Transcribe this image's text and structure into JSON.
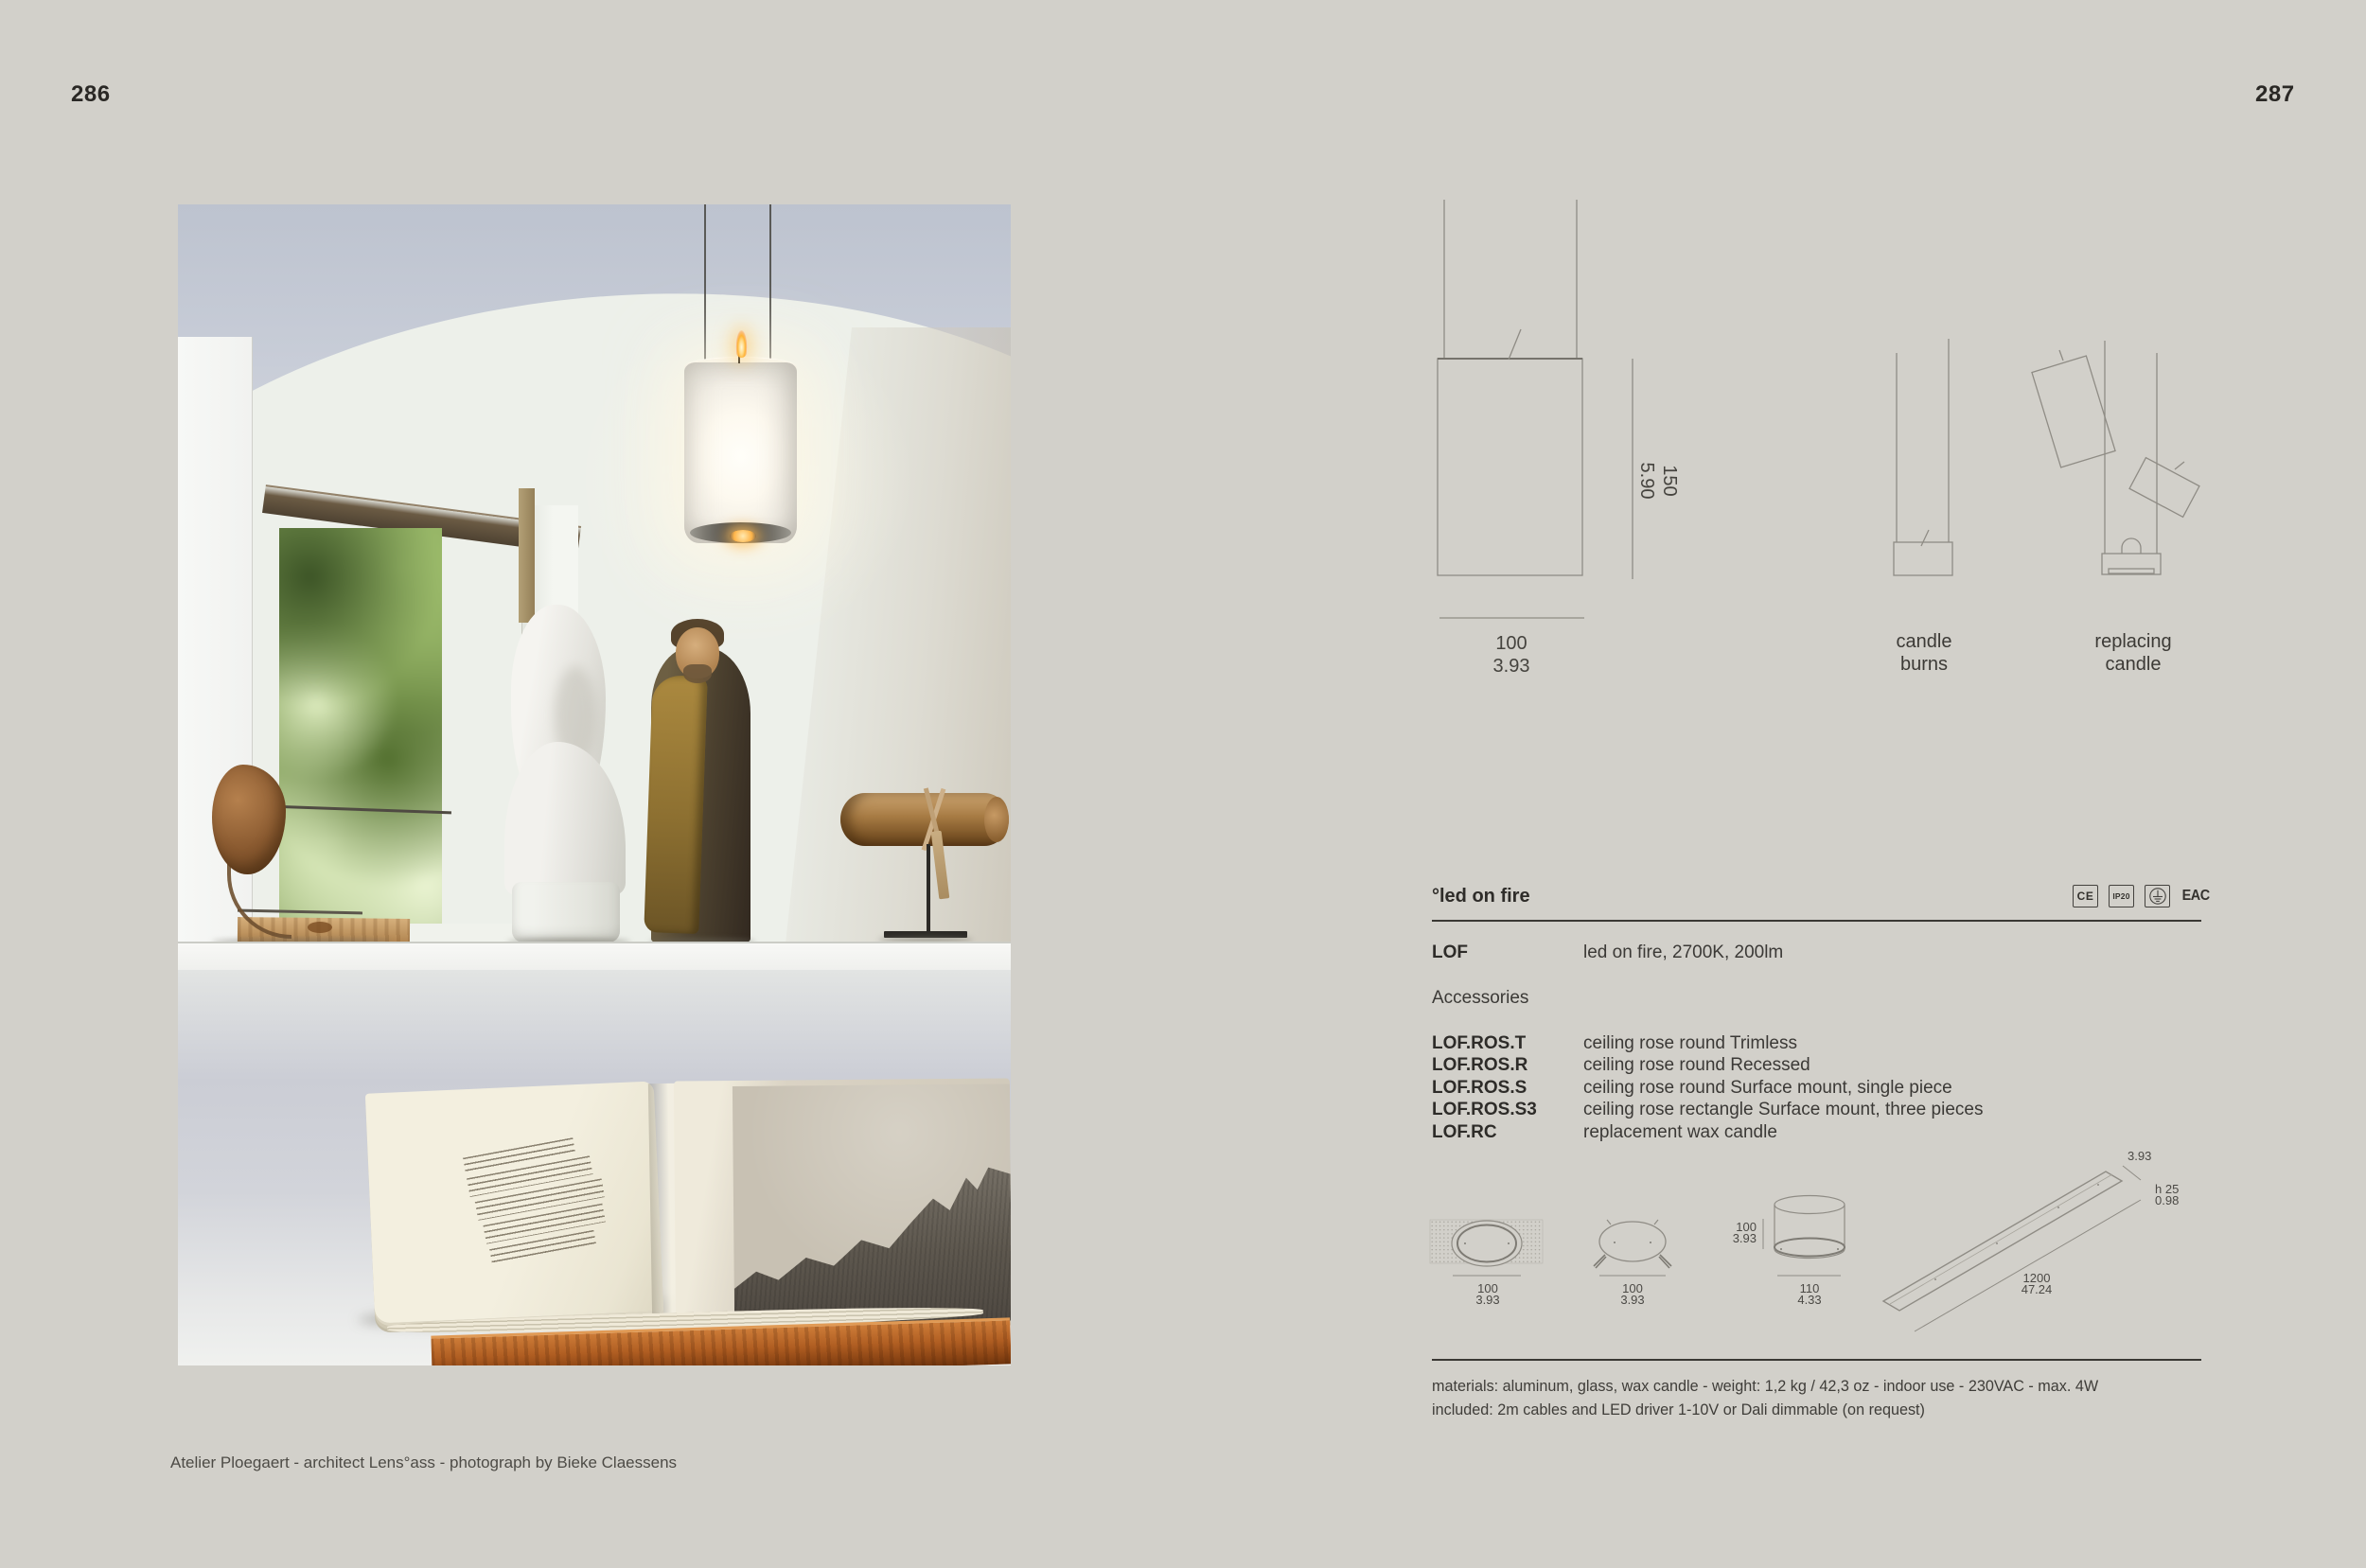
{
  "page": {
    "left_number": "286",
    "right_number": "287",
    "caption": "Atelier Ploegaert - architect Lens°ass - photograph by Bieke Claessens"
  },
  "pendant_diagram": {
    "height_mm": "150",
    "height_in": "5.90",
    "width_mm": "100",
    "width_in": "3.93"
  },
  "sequence_diagrams": {
    "burn_line1": "candle",
    "burn_line2": "burns",
    "replace_line1": "replacing",
    "replace_line2": "candle"
  },
  "spec": {
    "title": "°led on fire",
    "certifications": {
      "ce": "CE",
      "ip": "IP20",
      "eac": "EAC"
    },
    "product": {
      "code": "LOF",
      "description": "led on fire, 2700K, 200lm"
    },
    "accessories_heading": "Accessories",
    "accessories": [
      {
        "code": "LOF.ROS.T",
        "description": "ceiling rose round Trimless"
      },
      {
        "code": "LOF.ROS.R",
        "description": "ceiling rose round Recessed"
      },
      {
        "code": "LOF.ROS.S",
        "description": "ceiling rose round Surface mount, single piece"
      },
      {
        "code": "LOF.ROS.S3",
        "description": "ceiling rose rectangle Surface mount, three pieces"
      },
      {
        "code": "LOF.RC",
        "description": "replacement wax candle"
      }
    ],
    "materials_line1": "materials: aluminum, glass, wax candle - weight: 1,2 kg / 42,3 oz - indoor use - 230VAC - max. 4W",
    "materials_line2": "included: 2m cables and LED driver 1-10V or Dali dimmable (on request)"
  },
  "accessory_diagrams": {
    "rose_trimless": {
      "dim_mm": "100",
      "dim_in": "3.93"
    },
    "rose_recessed": {
      "dim_mm": "100",
      "dim_in": "3.93"
    },
    "rose_surface": {
      "height_mm": "100",
      "height_in": "3.93",
      "dim_mm": "110",
      "dim_in": "4.33"
    },
    "rose_rectangle": {
      "width_in": "3.93",
      "height_label": "h 25",
      "height_in": "0.98",
      "length_mm": "1200",
      "length_in": "47.24"
    }
  }
}
